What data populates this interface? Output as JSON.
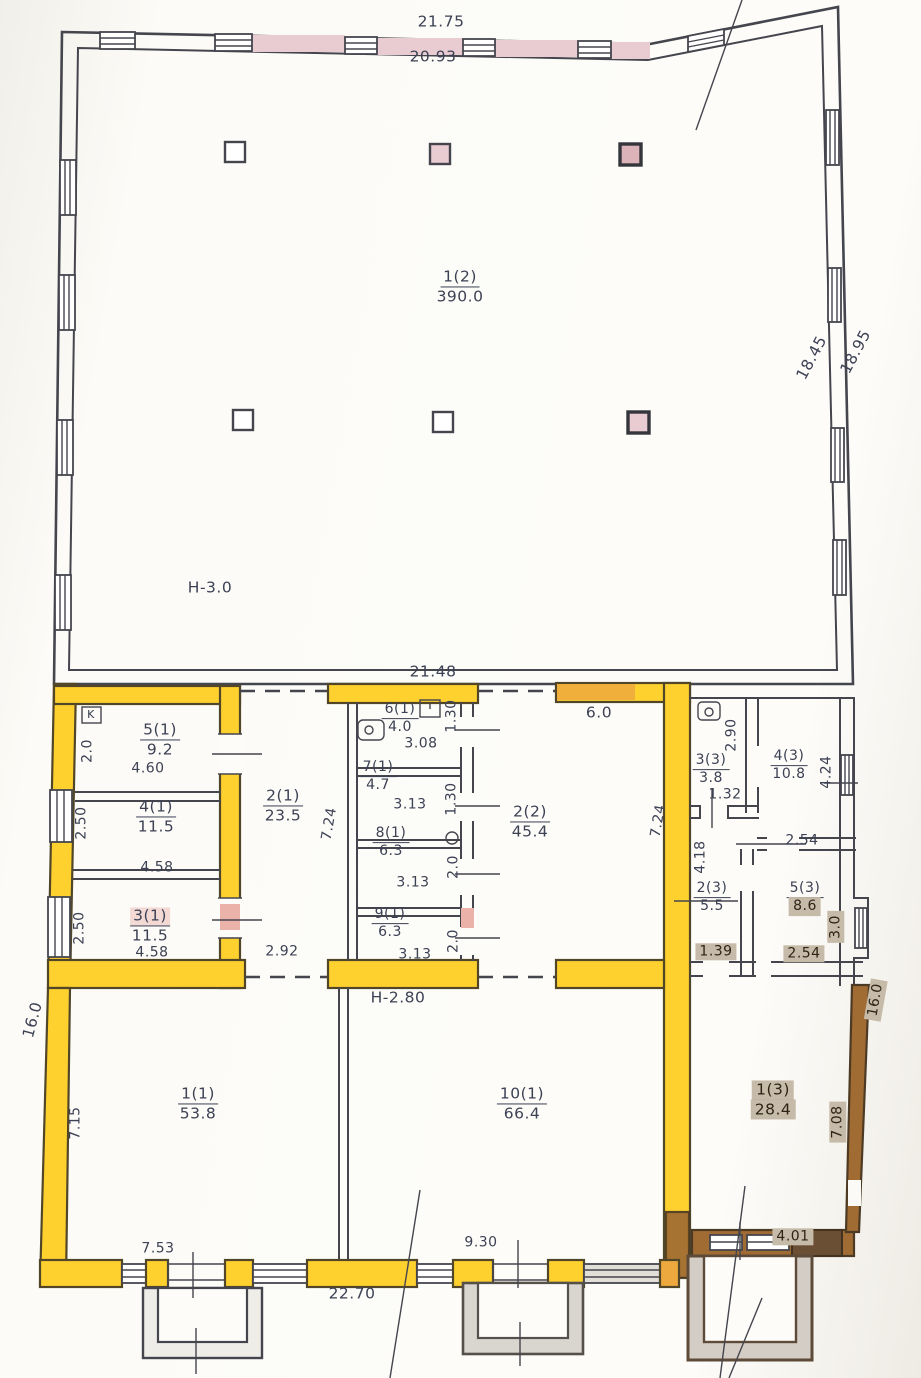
{
  "rooms": {
    "hall": {
      "num": "1(2)",
      "area": "390.0"
    },
    "r1_1": {
      "num": "1(1)",
      "area": "53.8"
    },
    "r2_1": {
      "num": "2(1)",
      "area": "23.5"
    },
    "r3_1": {
      "num": "3(1)",
      "area": "11.5"
    },
    "r4_1": {
      "num": "4(1)",
      "area": "11.5"
    },
    "r5_1": {
      "num": "5(1)",
      "area": "9.2"
    },
    "r6_1": {
      "num": "6(1)",
      "area": "4.0"
    },
    "r7_1": {
      "num": "7(1)",
      "area": "4.7"
    },
    "r8_1": {
      "num": "8(1)",
      "area": "6.3"
    },
    "r9_1": {
      "num": "9(1)",
      "area": "6.3"
    },
    "r10_1": {
      "num": "10(1)",
      "area": "66.4"
    },
    "r2_2": {
      "num": "2(2)",
      "area": "45.4"
    },
    "r1_3": {
      "num": "1(3)",
      "area": "28.4"
    },
    "r2_3": {
      "num": "2(3)",
      "area": "5.5"
    },
    "r3_3": {
      "num": "3(3)",
      "area": "3.8"
    },
    "r4_3": {
      "num": "4(3)",
      "area": "10.8"
    },
    "r5_3": {
      "num": "5(3)",
      "area": "8.6"
    }
  },
  "heights": {
    "hall": "H-3.0",
    "annex": "H-2.80"
  },
  "markers": {
    "k": "K"
  },
  "dims": {
    "top_outer": "21.75",
    "top_inner": "20.93",
    "right_inner": "18.45",
    "right_outer": "18.95",
    "mid_top": "21.48",
    "r5_h": "2.0",
    "r5_w": "4.60",
    "r4_h": "2.50",
    "r4_w": "4.58",
    "r3_h": "2.50",
    "r3_w": "4.58",
    "corr_h": "7.24",
    "corr_w": "2.92",
    "r6_w": "3.08",
    "r6_h": "1.30",
    "r7_w": "3.13",
    "r7_h": "1.30",
    "r8_w": "3.13",
    "r8_h": "2.0",
    "r9_w": "3.13",
    "r9_h": "2.0",
    "r22_top": "6.0",
    "r22_h": "7.24",
    "r33_h": "2.90",
    "r33_w": "1.32",
    "r43_h": "4.24",
    "r43_w": "2.54",
    "mid_right_h": "4.18",
    "r53_h": "3.0",
    "r53_w": "2.54",
    "r23_w": "1.39",
    "r11_h": "7.15",
    "r11_w": "7.53",
    "bottom_w": "22.70",
    "r101_w": "9.30",
    "left_lower_h": "16.0",
    "right_lower_h": "16.0",
    "r13_h": "7.08",
    "r13_w": "4.01"
  },
  "colors": {
    "wall_highlight": "#ffd12f",
    "window_band": "#e9ccd1",
    "annex_wall": "#a06c33",
    "label_patch": "#c6baa9",
    "ink": "#45454e"
  }
}
